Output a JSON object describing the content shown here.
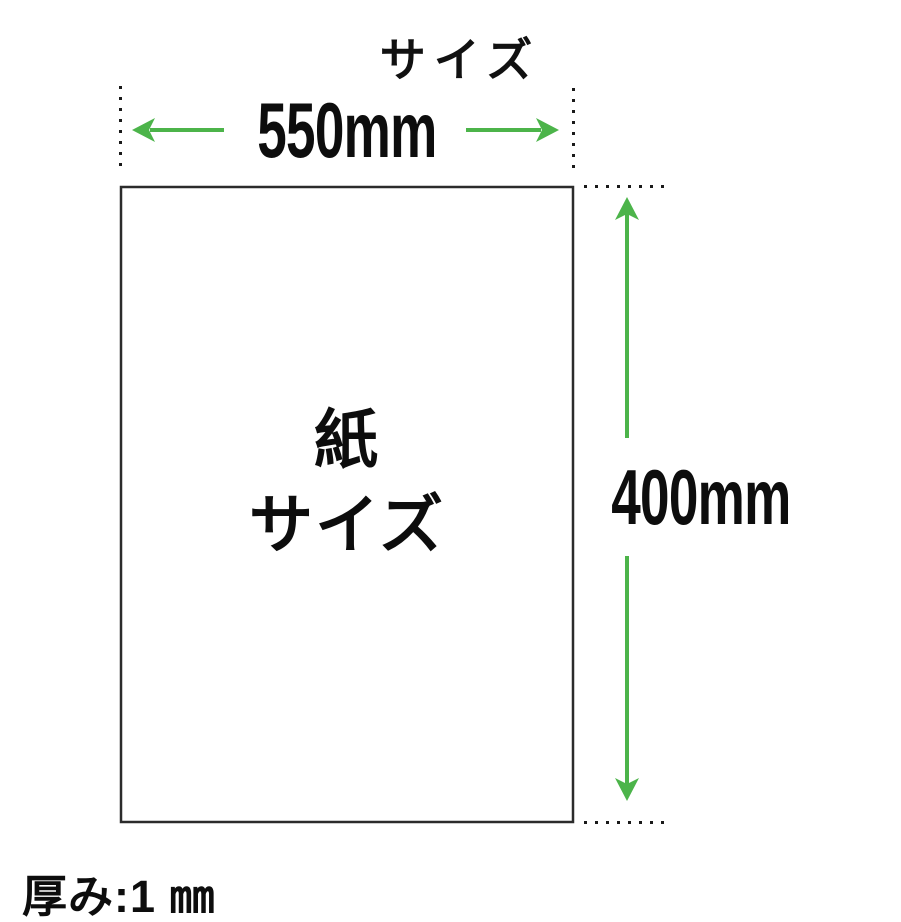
{
  "title": "サイズ",
  "width_dimension": {
    "label": "550mm"
  },
  "height_dimension": {
    "label": "400mm"
  },
  "thickness": {
    "label": "厚み:1 ㎜"
  },
  "paper": {
    "label_line1": "紙",
    "label_line2": "サイズ"
  },
  "colors": {
    "arrow_green": "#4cb44a",
    "line_dark": "#1a1a1a",
    "rect_border": "#2b2b2b"
  }
}
